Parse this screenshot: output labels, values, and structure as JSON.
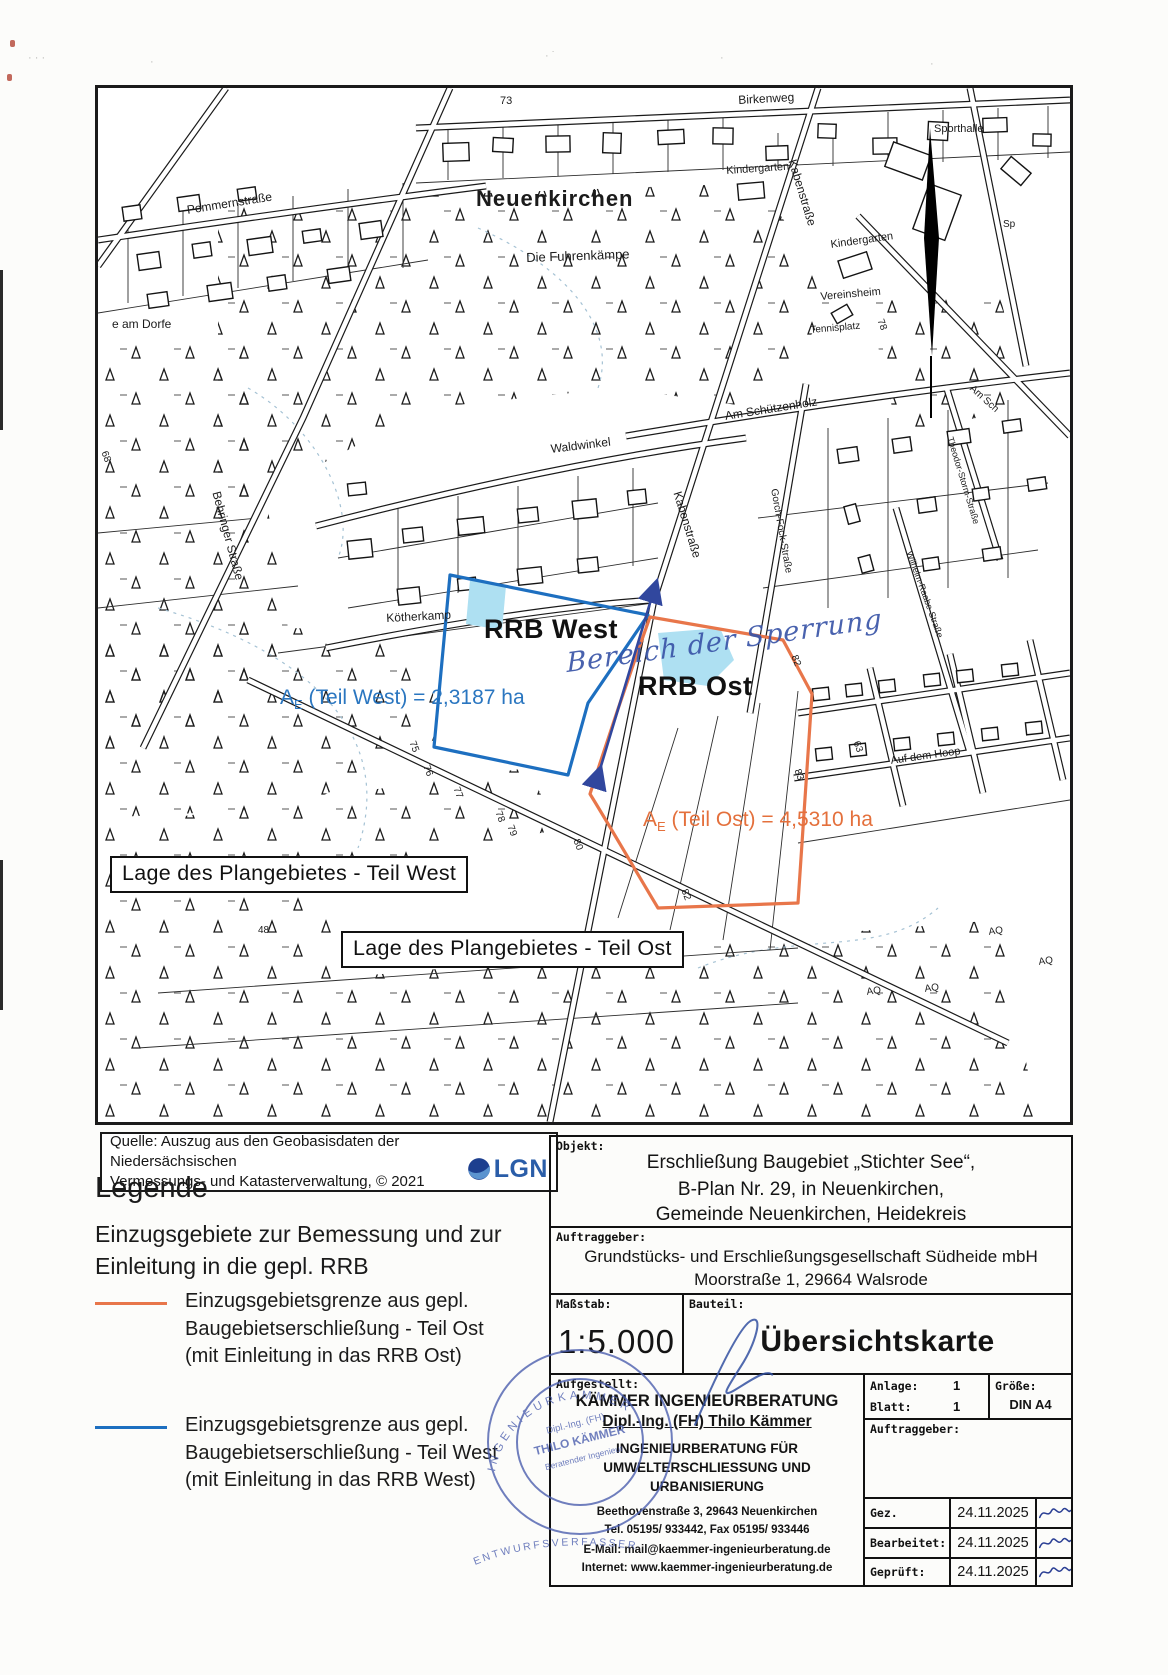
{
  "map": {
    "town": "Neuenkirchen",
    "rrb_west": "RRB West",
    "rrb_ost": "RRB Ost",
    "area_west": {
      "sym": "A",
      "sub": "E",
      "text": " (Teil West) = 2,3187 ha"
    },
    "area_ost": {
      "sym": "A",
      "sub": "E",
      "text": " (Teil Ost) = 4,5310 ha"
    },
    "note": "Bereich der Sperrung",
    "box_west": "Lage des Plangebietes - Teil West",
    "box_ost": "Lage des Plangebietes - Teil Ost",
    "labels": [
      {
        "t": "73",
        "x": 402,
        "y": 8,
        "r": 0,
        "s": 11
      },
      {
        "t": "Birkenweg",
        "x": 640,
        "y": 6,
        "r": -3,
        "s": 12
      },
      {
        "t": "Pommernstraße",
        "x": 88,
        "y": 116,
        "r": -9,
        "s": 12
      },
      {
        "t": "e am Dorfe",
        "x": 14,
        "y": 230,
        "r": 0,
        "s": 12
      },
      {
        "t": "Die Fuhrenkämpe",
        "x": 428,
        "y": 163,
        "r": -2,
        "s": 13
      },
      {
        "t": "Kindergarten",
        "x": 628,
        "y": 78,
        "r": -4,
        "s": 11
      },
      {
        "t": "Kabenstraße",
        "x": 700,
        "y": 70,
        "r": 73,
        "s": 12
      },
      {
        "t": "Sporthalle",
        "x": 836,
        "y": 36,
        "r": 0,
        "s": 11
      },
      {
        "t": "Sp",
        "x": 905,
        "y": 132,
        "r": 0,
        "s": 10
      },
      {
        "t": "Kindergarten",
        "x": 732,
        "y": 152,
        "r": -8,
        "s": 11
      },
      {
        "t": "Vereinsheim",
        "x": 722,
        "y": 204,
        "r": -5,
        "s": 11
      },
      {
        "t": "Tennisplatz",
        "x": 712,
        "y": 238,
        "r": -5,
        "s": 10
      },
      {
        "t": "78",
        "x": 786,
        "y": 230,
        "r": 70,
        "s": 10
      },
      {
        "t": "Am Sch",
        "x": 876,
        "y": 296,
        "r": 42,
        "s": 10
      },
      {
        "t": "Am Schützenholz",
        "x": 626,
        "y": 322,
        "r": -9,
        "s": 12
      },
      {
        "t": "Waldwinkel",
        "x": 452,
        "y": 355,
        "r": -7,
        "s": 12
      },
      {
        "t": "Kabenstraße",
        "x": 585,
        "y": 402,
        "r": 73,
        "s": 12
      },
      {
        "t": "Gorch-Fock-Straße",
        "x": 680,
        "y": 400,
        "r": 80,
        "s": 10
      },
      {
        "t": "Theodor-Storm-Straße",
        "x": 856,
        "y": 348,
        "r": 73,
        "s": 9
      },
      {
        "t": "Wilhelm-Raabe-Straße",
        "x": 815,
        "y": 462,
        "r": 70,
        "s": 9
      },
      {
        "t": "Behringer Straße",
        "x": 124,
        "y": 402,
        "r": 75,
        "s": 12
      },
      {
        "t": "Kötherkamp",
        "x": 288,
        "y": 524,
        "r": -3,
        "s": 12
      },
      {
        "t": "68",
        "x": 10,
        "y": 362,
        "r": 70,
        "s": 10
      },
      {
        "t": "Auf dem Hoop",
        "x": 792,
        "y": 668,
        "r": -8,
        "s": 11
      },
      {
        "t": "63",
        "x": 762,
        "y": 652,
        "r": 70,
        "s": 10
      },
      {
        "t": "75",
        "x": 318,
        "y": 652,
        "r": 70,
        "s": 10
      },
      {
        "t": "76",
        "x": 332,
        "y": 676,
        "r": 70,
        "s": 10
      },
      {
        "t": "77",
        "x": 362,
        "y": 698,
        "r": 70,
        "s": 10
      },
      {
        "t": "78",
        "x": 404,
        "y": 722,
        "r": 70,
        "s": 10
      },
      {
        "t": "79",
        "x": 416,
        "y": 736,
        "r": 70,
        "s": 10
      },
      {
        "t": "80",
        "x": 482,
        "y": 750,
        "r": 70,
        "s": 10
      },
      {
        "t": "82",
        "x": 590,
        "y": 800,
        "r": 70,
        "s": 10
      },
      {
        "t": "82",
        "x": 700,
        "y": 566,
        "r": 70,
        "s": 10
      },
      {
        "t": "83",
        "x": 703,
        "y": 680,
        "r": 70,
        "s": 10
      },
      {
        "t": "48",
        "x": 160,
        "y": 838,
        "r": 0,
        "s": 10
      },
      {
        "t": "AQ",
        "x": 890,
        "y": 840,
        "r": -8,
        "s": 10
      },
      {
        "t": "AQ",
        "x": 768,
        "y": 900,
        "r": -8,
        "s": 10
      },
      {
        "t": "AQ",
        "x": 826,
        "y": 897,
        "r": -8,
        "s": 10
      },
      {
        "t": "AQ",
        "x": 940,
        "y": 870,
        "r": -8,
        "s": 10
      }
    ]
  },
  "source": {
    "line1": "Quelle: Auszug aus den Geobasisdaten der Niedersächsischen",
    "line2": "Vermessungs- und Katasterverwaltung, © 2021",
    "logo": "LGN"
  },
  "legend": {
    "title": "Legende",
    "intro1": "Einzugsgebiete zur Bemessung und zur",
    "intro2": "Einleitung in die gepl. RRB",
    "items": [
      {
        "color": "#e8764a",
        "line1": "Einzugsgebietsgrenze aus gepl.",
        "line2": "Baugebietserschließung - Teil Ost",
        "line3": "(mit Einleitung in das RRB Ost)"
      },
      {
        "color": "#1d6fc0",
        "line1": "Einzugsgebietsgrenze aus gepl.",
        "line2": "Baugebietserschließung - Teil West",
        "line3": "(mit Einleitung in das RRB West)"
      }
    ]
  },
  "title_block": {
    "objekt_label": "Objekt:",
    "objekt1": "Erschließung Baugebiet „Stichter See“,",
    "objekt2": "B-Plan Nr. 29, in Neuenkirchen,",
    "objekt3": "Gemeinde Neuenkirchen, Heidekreis",
    "auftraggeber_label": "Auftraggeber:",
    "auftraggeber1": "Grundstücks- und Erschließungsgesellschaft Südheide mbH",
    "auftraggeber2": "Moorstraße 1, 29664 Walsrode",
    "massstab_label": "Maßstab:",
    "massstab": "1:5.000",
    "bauteil_label": "Bauteil:",
    "bauteil": "Übersichtskarte",
    "aufgestellt_label": "Aufgestellt:",
    "firm1": "KÄMMER INGENIEURBERATUNG",
    "firm2": "Dipl.-Ing. (FH) Thilo Kämmer",
    "firm3": "INGENIEURBERATUNG FÜR",
    "firm4": "UMWELTERSCHLIESSUNG UND",
    "firm5": "URBANISIERUNG",
    "addr1": "Beethovenstraße 3, 29643 Neuenkirchen",
    "addr2": "Tel. 05195/ 933442, Fax 05195/ 933446",
    "addr3": "E-Mail: mail@kaemmer-ingenieurberatung.de",
    "addr4": "Internet: www.kaemmer-ingenieurberatung.de",
    "anlage_label": "Anlage:",
    "anlage": "1",
    "blatt_label": "Blatt:",
    "blatt": "1",
    "groesse_label": "Größe:",
    "groesse": "DIN A4",
    "auftraggeber2_label": "Auftraggeber:",
    "rows": [
      {
        "label": "Gez.",
        "date": "24.11.2025"
      },
      {
        "label": "Bearbeitet:",
        "date": "24.11.2025"
      },
      {
        "label": "Geprüft:",
        "date": "24.11.2025"
      }
    ]
  },
  "stamp": {
    "arc_top": "INGENIEURKAMMER",
    "line1": "Dipl.-Ing. (FH)",
    "line2": "THILO KÄMMER",
    "line3": "Beratender Ingenieur",
    "below": "ENTWURFSVERFASSER"
  },
  "colors": {
    "rrb_west_boundary": "#1d6fc0",
    "rrb_ost_boundary": "#e8764a",
    "water": "#aee0f2",
    "ink": "#3a55a8",
    "lgn_blue": "#2a5da8"
  }
}
